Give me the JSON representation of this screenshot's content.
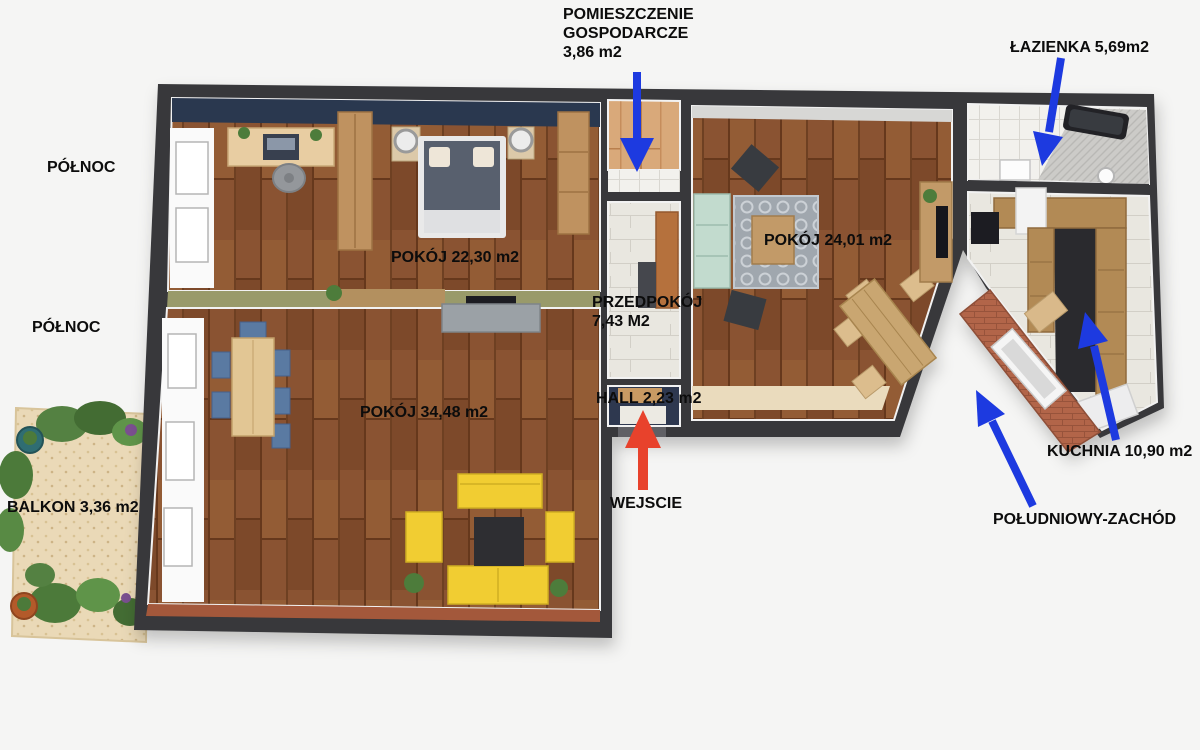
{
  "labels": {
    "utility_l1": "POMIESZCZENIE",
    "utility_l2": "GOSPODARCZE",
    "utility_l3": "3,86 m2",
    "bathroom": "ŁAZIENKA 5,69m2",
    "north_top": "PÓŁNOC",
    "north_bottom": "PÓŁNOC",
    "room_bedroom": "POKÓJ 22,30 m2",
    "hallway_l1": "PRZEDPOKÓJ",
    "hallway_l2": "7,43 M2",
    "hall": "HALL 2,23 m2",
    "room_living_right": "POKÓJ 24,01 m2",
    "room_living_left": "POKÓJ 34,48 m2",
    "balcony": "BALKON 3,36 m2",
    "entrance": "WEJSCIE",
    "kitchen": "KUCHNIA 10,90 m2",
    "southwest": "POŁUDNIOWY-ZACHÓD"
  },
  "colors": {
    "arrow_blue": "#1d3ae0",
    "arrow_red": "#e8422c",
    "wall": "#38383b",
    "wood_floor": "#8a5330",
    "wood_light": "#d9a97a",
    "divider_olive": "#999a6b",
    "sofa_yellow": "#f1cd33",
    "sofa_teal": "#c2dbce",
    "chair_blue": "#5a7aa2",
    "brick_terrace": "#b2654a",
    "balcony_sand": "#ead9b7"
  }
}
